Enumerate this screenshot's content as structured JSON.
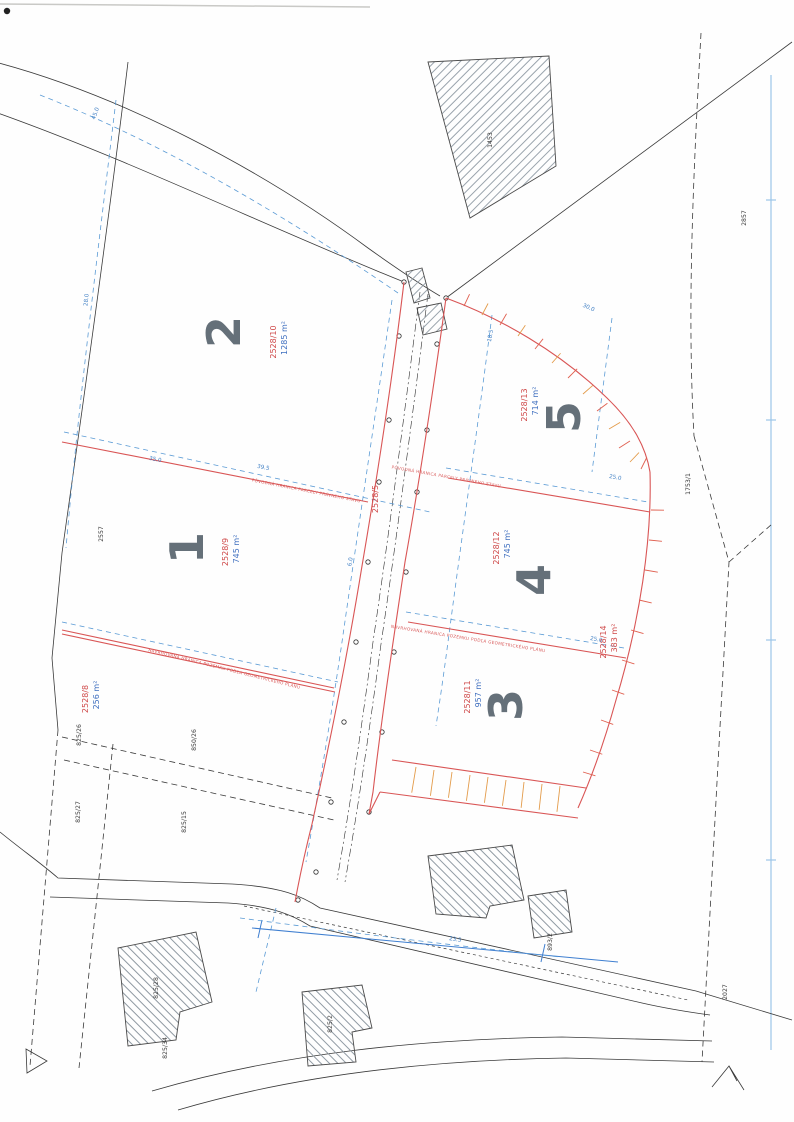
{
  "document": {
    "kind": "scanned cadastral subdivision plan",
    "colors": {
      "new_boundary_red": "#d95555",
      "dimension_blue": "#5b9bd5",
      "existing_black": "#3a3a3a",
      "slope_hatch_orange": "#e39b4a",
      "digit_gray": "#59646e"
    }
  },
  "parcels": [
    {
      "number": "1",
      "id": "2528/9",
      "area": "745 m²"
    },
    {
      "number": "2",
      "id": "2528/10",
      "area": "1285 m²"
    },
    {
      "number": "3",
      "id": "2528/11",
      "area": "957 m²"
    },
    {
      "number": "4",
      "id": "2528/12",
      "area": "745 m²"
    },
    {
      "number": "5",
      "id": "2528/13",
      "area": "714 m²"
    },
    {
      "number": "",
      "id": "2528/8",
      "area": "256 m²"
    },
    {
      "number": "",
      "id": "2528/14",
      "area": "383 m²"
    },
    {
      "number": "",
      "id": "2528/5",
      "area": ""
    }
  ],
  "neighbor_parcel_ids": [
    "1453",
    "2857",
    "1753/1",
    "2557",
    "2027",
    "825/26",
    "850/26",
    "825/27",
    "825/15",
    "825/28",
    "825/34",
    "825/2",
    "893/2"
  ],
  "plan": {
    "labels": [
      {
        "t": "1",
        "x": 203,
        "y": 548,
        "r": -90,
        "k": "digit"
      },
      {
        "t": "2",
        "x": 240,
        "y": 332,
        "r": -90,
        "k": "digit"
      },
      {
        "t": "3",
        "x": 522,
        "y": 705,
        "r": -90,
        "k": "digit"
      },
      {
        "t": "4",
        "x": 550,
        "y": 580,
        "r": -90,
        "k": "digit"
      },
      {
        "t": "5",
        "x": 580,
        "y": 417,
        "r": -90,
        "k": "digit"
      },
      {
        "t": "2528/9",
        "x": 228,
        "y": 552,
        "r": -90,
        "k": "pid"
      },
      {
        "t": "745 m²",
        "x": 239,
        "y": 549,
        "r": -90,
        "k": "area"
      },
      {
        "t": "2528/10",
        "x": 276,
        "y": 342,
        "r": -90,
        "k": "pid"
      },
      {
        "t": "1285 m²",
        "x": 287,
        "y": 338,
        "r": -90,
        "k": "area"
      },
      {
        "t": "2528/11",
        "x": 470,
        "y": 697,
        "r": -90,
        "k": "pid"
      },
      {
        "t": "957 m²",
        "x": 481,
        "y": 693,
        "r": -90,
        "k": "area"
      },
      {
        "t": "2528/12",
        "x": 499,
        "y": 548,
        "r": -90,
        "k": "pid"
      },
      {
        "t": "745 m²",
        "x": 510,
        "y": 544,
        "r": -90,
        "k": "area"
      },
      {
        "t": "2528/13",
        "x": 527,
        "y": 405,
        "r": -90,
        "k": "pid"
      },
      {
        "t": "714 m²",
        "x": 538,
        "y": 401,
        "r": -90,
        "k": "area"
      },
      {
        "t": "2528/8",
        "x": 88,
        "y": 699,
        "r": -90,
        "k": "pid"
      },
      {
        "t": "256 m²",
        "x": 99,
        "y": 695,
        "r": -90,
        "k": "area"
      },
      {
        "t": "2528/14",
        "x": 606,
        "y": 642,
        "r": -90,
        "k": "pid"
      },
      {
        "t": "383 m²",
        "x": 617,
        "y": 638,
        "r": -90,
        "k": "pid"
      },
      {
        "t": "2528/5",
        "x": 378,
        "y": 499,
        "r": -90,
        "k": "pid"
      },
      {
        "t": "1453",
        "x": 492,
        "y": 140,
        "r": -90,
        "k": "black"
      },
      {
        "t": "2857",
        "x": 746,
        "y": 218,
        "r": -90,
        "k": "black"
      },
      {
        "t": "1753/1",
        "x": 690,
        "y": 484,
        "r": -90,
        "k": "black"
      },
      {
        "t": "2557",
        "x": 103,
        "y": 534,
        "r": -90,
        "k": "black"
      },
      {
        "t": "2027",
        "x": 727,
        "y": 992,
        "r": -90,
        "k": "black"
      },
      {
        "t": "825/26",
        "x": 81,
        "y": 735,
        "r": -90,
        "k": "black"
      },
      {
        "t": "850/26",
        "x": 196,
        "y": 740,
        "r": -90,
        "k": "black"
      },
      {
        "t": "825/27",
        "x": 80,
        "y": 812,
        "r": -90,
        "k": "black"
      },
      {
        "t": "825/15",
        "x": 186,
        "y": 822,
        "r": -90,
        "k": "black"
      },
      {
        "t": "825/28",
        "x": 158,
        "y": 988,
        "r": -90,
        "k": "black"
      },
      {
        "t": "825/34",
        "x": 167,
        "y": 1048,
        "r": -90,
        "k": "black"
      },
      {
        "t": "825/2",
        "x": 332,
        "y": 1024,
        "r": -90,
        "k": "black"
      },
      {
        "t": "893/2",
        "x": 552,
        "y": 942,
        "r": -90,
        "k": "black"
      },
      {
        "t": "45.0",
        "x": 97,
        "y": 114,
        "r": -70,
        "k": "dim"
      },
      {
        "t": "28.0",
        "x": 88,
        "y": 300,
        "r": -84,
        "k": "dim"
      },
      {
        "t": "39.5",
        "x": 263,
        "y": 469,
        "r": 11,
        "k": "dim"
      },
      {
        "t": "35.0",
        "x": 155,
        "y": 461,
        "r": 11,
        "k": "dim"
      },
      {
        "t": "30.0",
        "x": 588,
        "y": 309,
        "r": 24,
        "k": "dim"
      },
      {
        "t": "25.0",
        "x": 615,
        "y": 479,
        "r": 10,
        "k": "dim"
      },
      {
        "t": "25.0",
        "x": 596,
        "y": 641,
        "r": 10,
        "k": "dim"
      },
      {
        "t": "18.5",
        "x": 492,
        "y": 336,
        "r": -80,
        "k": "dim"
      },
      {
        "t": "6.0",
        "x": 352,
        "y": 562,
        "r": -81,
        "k": "dim"
      },
      {
        "t": "23.5",
        "x": 455,
        "y": 941,
        "r": 9,
        "k": "dim"
      },
      {
        "t": "NAVRHOVANÁ HRANICA POZEMKU PODĽA GEOMETRICKÉHO PLÁNU",
        "x": 224,
        "y": 670,
        "r": 14,
        "k": "anno"
      },
      {
        "t": "PÔVODNÁ HRANICA PARCELY PRÁVNEHO STAVU",
        "x": 306,
        "y": 492,
        "r": 11,
        "k": "anno"
      },
      {
        "t": "PÔVODNÁ HRANICA PARCELY PRÁVNEHO STAVU",
        "x": 446,
        "y": 478,
        "r": 10,
        "k": "anno"
      },
      {
        "t": "NAVRHOVANÁ HRANICA POZEMKU PODĽA GEOMETRICKÉHO PLÁNU",
        "x": 468,
        "y": 640,
        "r": 9,
        "k": "anno"
      }
    ]
  }
}
